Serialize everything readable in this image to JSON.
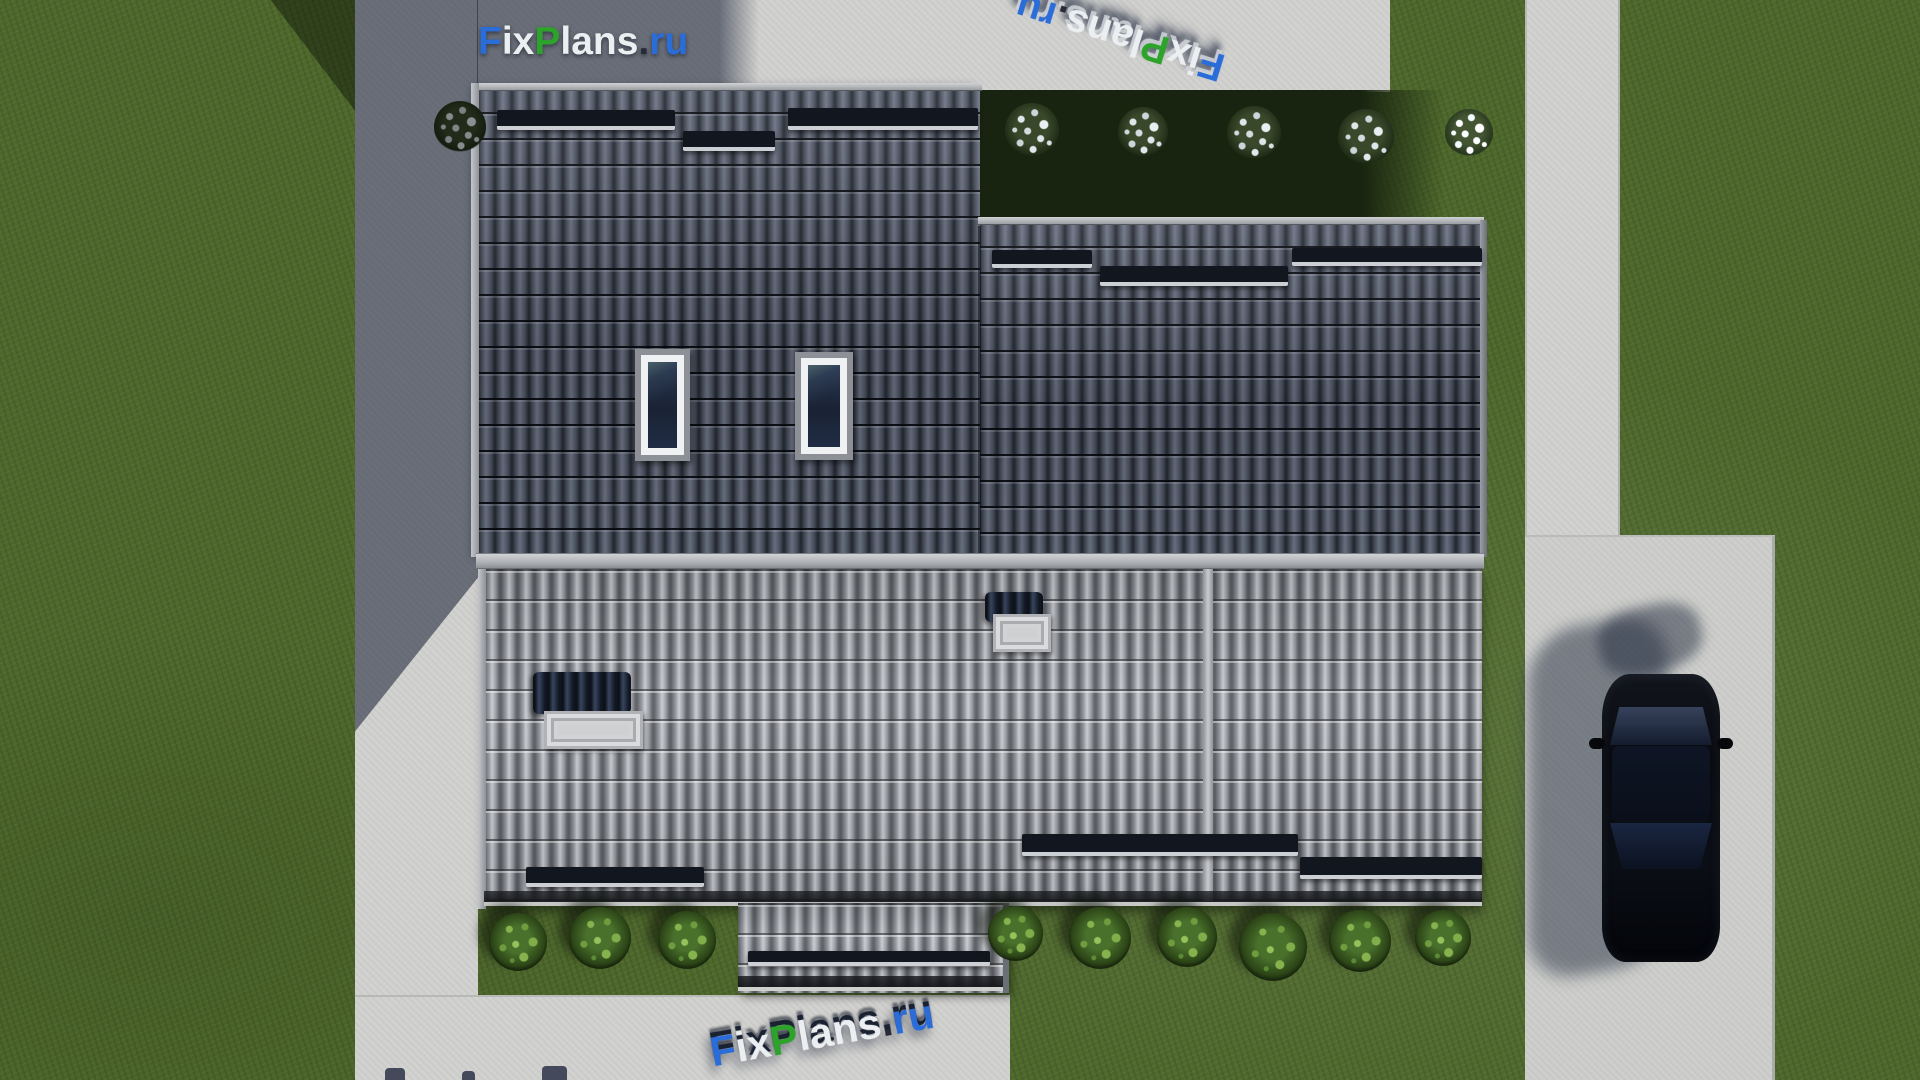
{
  "brand": {
    "name": "FixPlans.ru",
    "letters": [
      {
        "t": "F",
        "color": "blue"
      },
      {
        "t": "ix",
        "color": "white"
      },
      {
        "t": "P",
        "color": "green"
      },
      {
        "t": "lans",
        "color": "white"
      },
      {
        "t": ".",
        "color": "dark"
      },
      {
        "t": "ru",
        "color": "blue"
      }
    ]
  },
  "watermarks": {
    "top_left_logo": {
      "text": "FixPlans.ru",
      "style": "flat",
      "rotation_deg": 0
    },
    "top_right_mark": {
      "text": "FixPlans.ru",
      "style": "3d-extruded",
      "rotation_deg": 197
    },
    "bottom_mark": {
      "text": "FixPlans.ru",
      "style": "3d-extruded",
      "rotation_deg": -10
    },
    "bottom_edge_fragment": {
      "legible": false
    }
  },
  "scene_objects": {
    "skylights": 2,
    "roof_hatches": 2,
    "snow_guard_rows": 10,
    "white_flower_bushes": 6,
    "green_bushes": 9,
    "vehicles": 1
  },
  "palette": {
    "brand_blue": "#2a6cd8",
    "brand_green": "#2da32b",
    "brand_white": "#eceff2",
    "brand_dark": "#262b36",
    "grass": "#4e682c",
    "grass_shadow": "#18240f",
    "concrete": "#d1d1cf",
    "driveway": "#cdcecb",
    "shadow_tint": "rgba(30,38,58,0.58)",
    "roof_dark_tile": "#4a5160",
    "roof_light_tile": "#a0a3a7",
    "ridge_cap": "#b9bcc0",
    "snow_guard": "#11161f",
    "skylight_glass": "#1a2334",
    "hatch_panel": "#1c2639",
    "hatch_box": "#cfd0d2",
    "car_body": "#090b10",
    "car_glass": "#141d2e"
  }
}
